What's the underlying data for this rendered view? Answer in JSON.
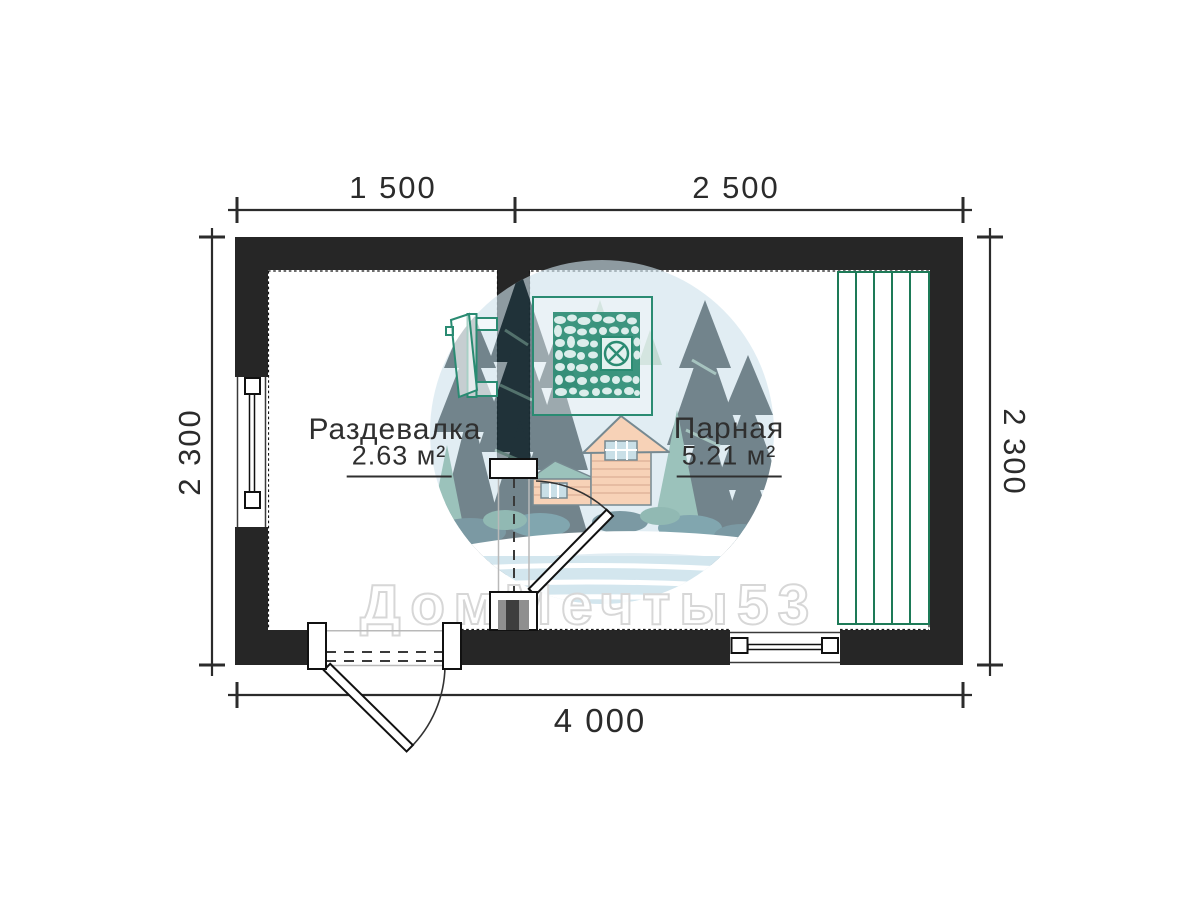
{
  "watermark": {
    "text": "ДомМечты53"
  },
  "dimensions": {
    "top_left": "1 500",
    "top_right": "2 500",
    "side_left": "2 300",
    "side_right": "2 300",
    "bottom": "4 000"
  },
  "rooms": [
    {
      "name": "Раздевалка",
      "area": "2.63 м²"
    },
    {
      "name": "Парная",
      "area": "5.21 м²"
    }
  ],
  "icons": {
    "stove": "sauna-stove-icon",
    "vent": "vent-hatch-icon",
    "bench": "bench-slats-icon",
    "logo": "company-logo",
    "entrance_door": "entrance-door-swing",
    "interior_door": "interior-door-swing",
    "left_window": "left-wall-window",
    "bottom_window": "bottom-wall-window"
  },
  "colors": {
    "wall": "#262626",
    "dimension": "#2b2b2b",
    "fixture_teal": "#2a8b72",
    "bench_green": "#1d7a57",
    "watermark_outline": "#d7d7d7",
    "logo_circle": "#cfe3ed"
  }
}
